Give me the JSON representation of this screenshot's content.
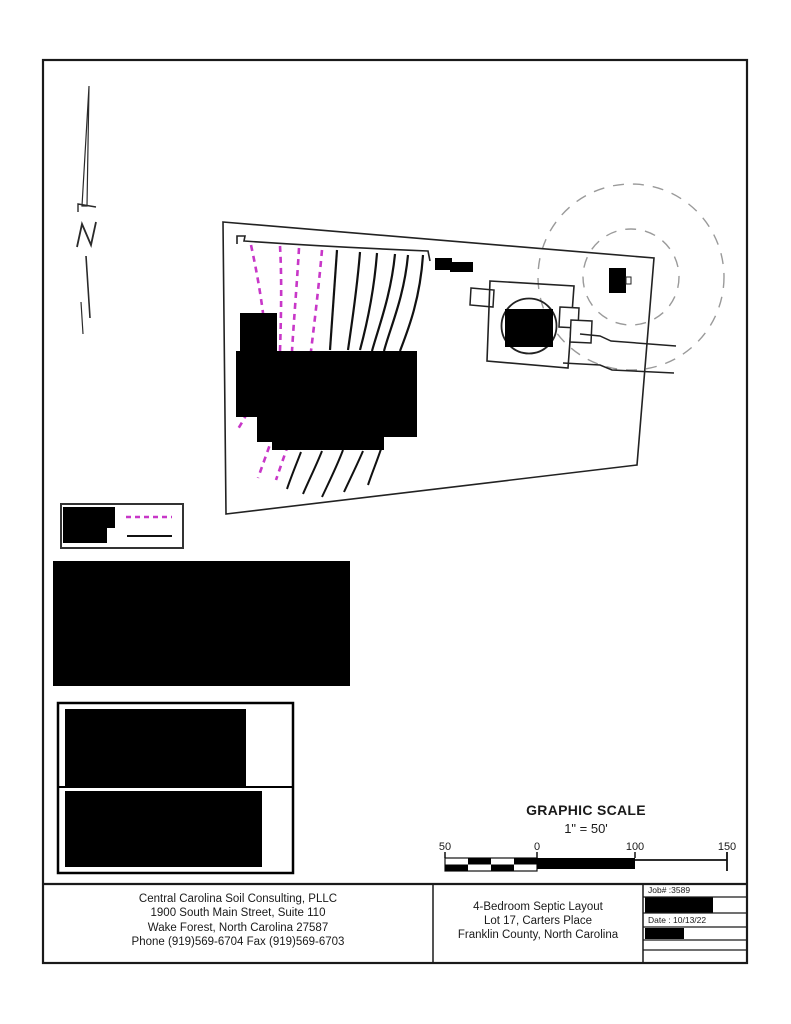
{
  "scale_block": {
    "title": "GRAPHIC SCALE",
    "ratio": "1\" = 50'",
    "tick_labels": [
      "50",
      "0",
      "100",
      "150"
    ]
  },
  "title_block": {
    "firm_lines": [
      "Central Carolina Soil Consulting, PLLC",
      "1900 South Main Street, Suite 110",
      "Wake Forest, North Carolina 27587",
      "Phone (919)569-6704 Fax (919)569-6703"
    ],
    "project_lines": [
      "4-Bedroom Septic Layout",
      "Lot 17, Carters Place",
      "Franklin County, North Carolina"
    ],
    "job_number_label": "Job# :3589",
    "date_label": "Date : 10/13/22"
  },
  "colors": {
    "magenta_line": "#c837c8",
    "setback_circle_gray": "#9a9a9a",
    "ink": "#1a1a1a"
  }
}
